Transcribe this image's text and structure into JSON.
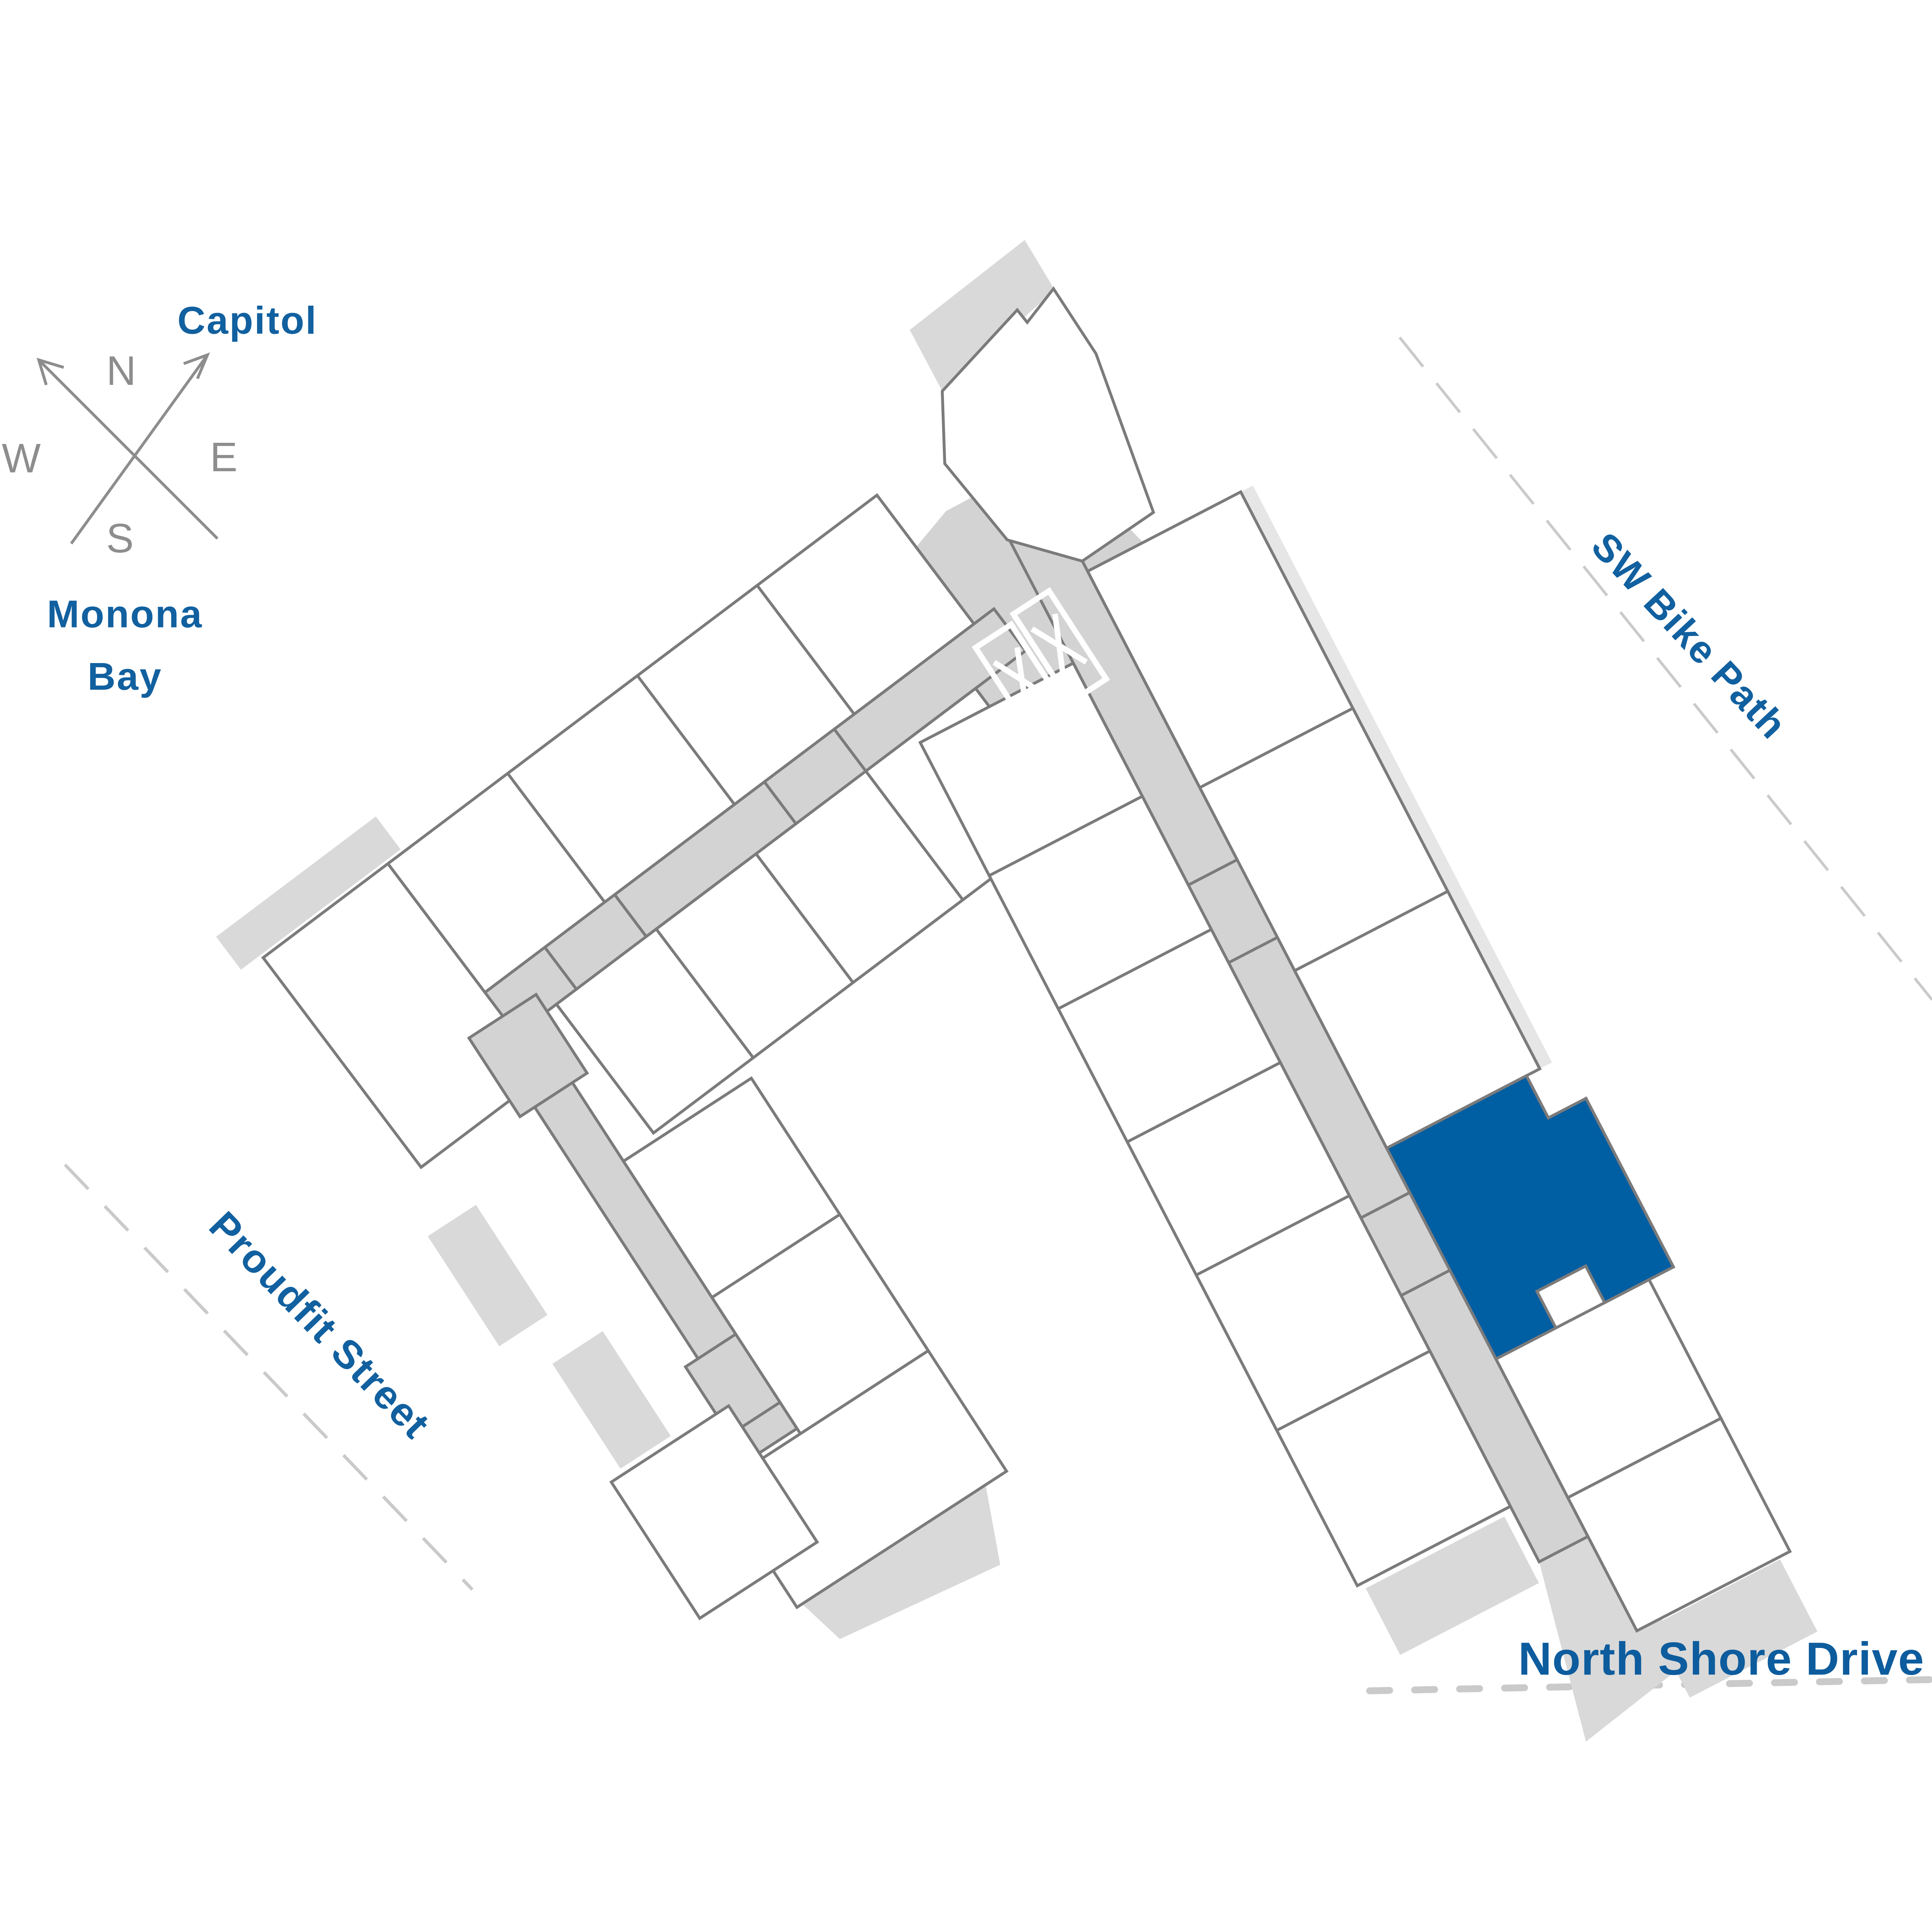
{
  "compass": {
    "north": "N",
    "east": "E",
    "south": "S",
    "west": "W"
  },
  "labels": {
    "capitol": "Capitol",
    "monona_bay_line1": "Monona",
    "monona_bay_line2": "Bay",
    "sw_bike_path": "SW Bike Path",
    "proudfit_street": "Proudfit Street",
    "north_shore_drive": "North Shore Drive"
  },
  "icons": {
    "compass": "crossed-arrows-compass",
    "stair_left": "x-mark",
    "stair_right": "x-mark"
  },
  "colors": {
    "highlight_blue": "#005ea3",
    "label_blue": "#11609f",
    "outline_gray": "#7b7b7b",
    "corridor_gray": "#d3d3d3",
    "balcony_gray": "#d9d9d9",
    "compass_gray": "#8d8d8d",
    "street_dash_gray": "#cacaca"
  },
  "highlighted_unit": {
    "selected": true
  }
}
